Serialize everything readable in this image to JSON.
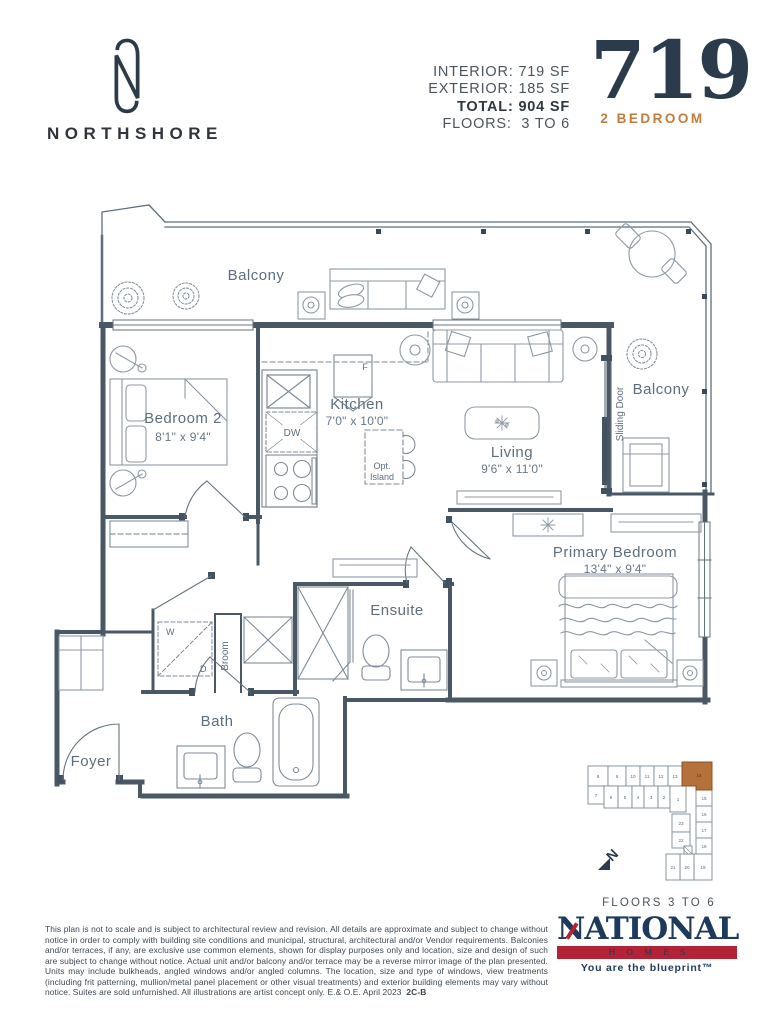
{
  "header": {
    "brand": "NORTHSHORE",
    "stats": [
      {
        "label": "INTERIOR:",
        "value": "719 SF"
      },
      {
        "label": "EXTERIOR:",
        "value": "185 SF"
      },
      {
        "label": "TOTAL:",
        "value": "904 SF"
      },
      {
        "label": "FLOORS:",
        "value": "3 TO 6"
      }
    ],
    "unit_number": "719",
    "unit_type": "2 BEDROOM"
  },
  "plan": {
    "balcony_top": "Balcony",
    "balcony_right": "Balcony",
    "sliding_door": "Sliding Door",
    "bedroom2_name": "Bedroom 2",
    "bedroom2_dim": "8'1\" x 9'4\"",
    "kitchen_name": "Kitchen",
    "kitchen_dim": "7'0\" x 10'0\"",
    "living_name": "Living",
    "living_dim": "9'6\" x 11'0\"",
    "primary_name": "Primary Bedroom",
    "primary_dim": "13'4\" x 9'4\"",
    "ensuite": "Ensuite",
    "bath": "Bath",
    "foyer": "Foyer",
    "broom": "Broom",
    "opt_island_1": "Opt.",
    "opt_island_2": "Island",
    "dw": "DW",
    "fridge": "F",
    "washer": "W",
    "dryer": "D"
  },
  "keyplan": {
    "units": [
      "1",
      "2",
      "3",
      "4",
      "5",
      "6",
      "7",
      "8",
      "9",
      "10",
      "11",
      "12",
      "13",
      "14",
      "15",
      "16",
      "17",
      "18",
      "19",
      "20",
      "21",
      "22",
      "23"
    ],
    "highlighted_unit": "14",
    "north": "N",
    "floors_label": "FLOORS  3 TO 6"
  },
  "footer": {
    "disclaimer": "This plan is not to scale and is subject to architectural review and revision. All details are approximate and subject to change without notice in order to comply with building site conditions and municipal, structural, architectural and/or Vendor requirements. Balconies and/or terraces, if any, are exclusive use common elements, shown for display purposes only and location, size and design of such are subject to change without notice. Actual unit and/or balcony and/or terrace may be a reverse mirror image of the plan presented. Units may include bulkheads, angled windows and/or angled columns. The location, size and type of windows, view treatments (including frit patterning, mullion/metal panel placement or other visual treatments) and exterior building elements may vary without notice. Suites are sold unfurnished. All illustrations are artist concept only. E.& O.E. April 2023",
    "plan_code": "2C-B",
    "national_name": "NATIONAL",
    "national_homes": "HOMES",
    "national_tagline": "You are the blueprint™"
  },
  "colors": {
    "navy": "#2c3b4c",
    "accent_orange": "#c07c3e",
    "wall": "#4a5765",
    "line": "#6b7a87",
    "furniture": "#8c99a5",
    "label": "#5d6e7e",
    "keyplan_highlight": "#b5713a",
    "national_navy": "#1d3a5c",
    "national_red": "#b22335"
  }
}
